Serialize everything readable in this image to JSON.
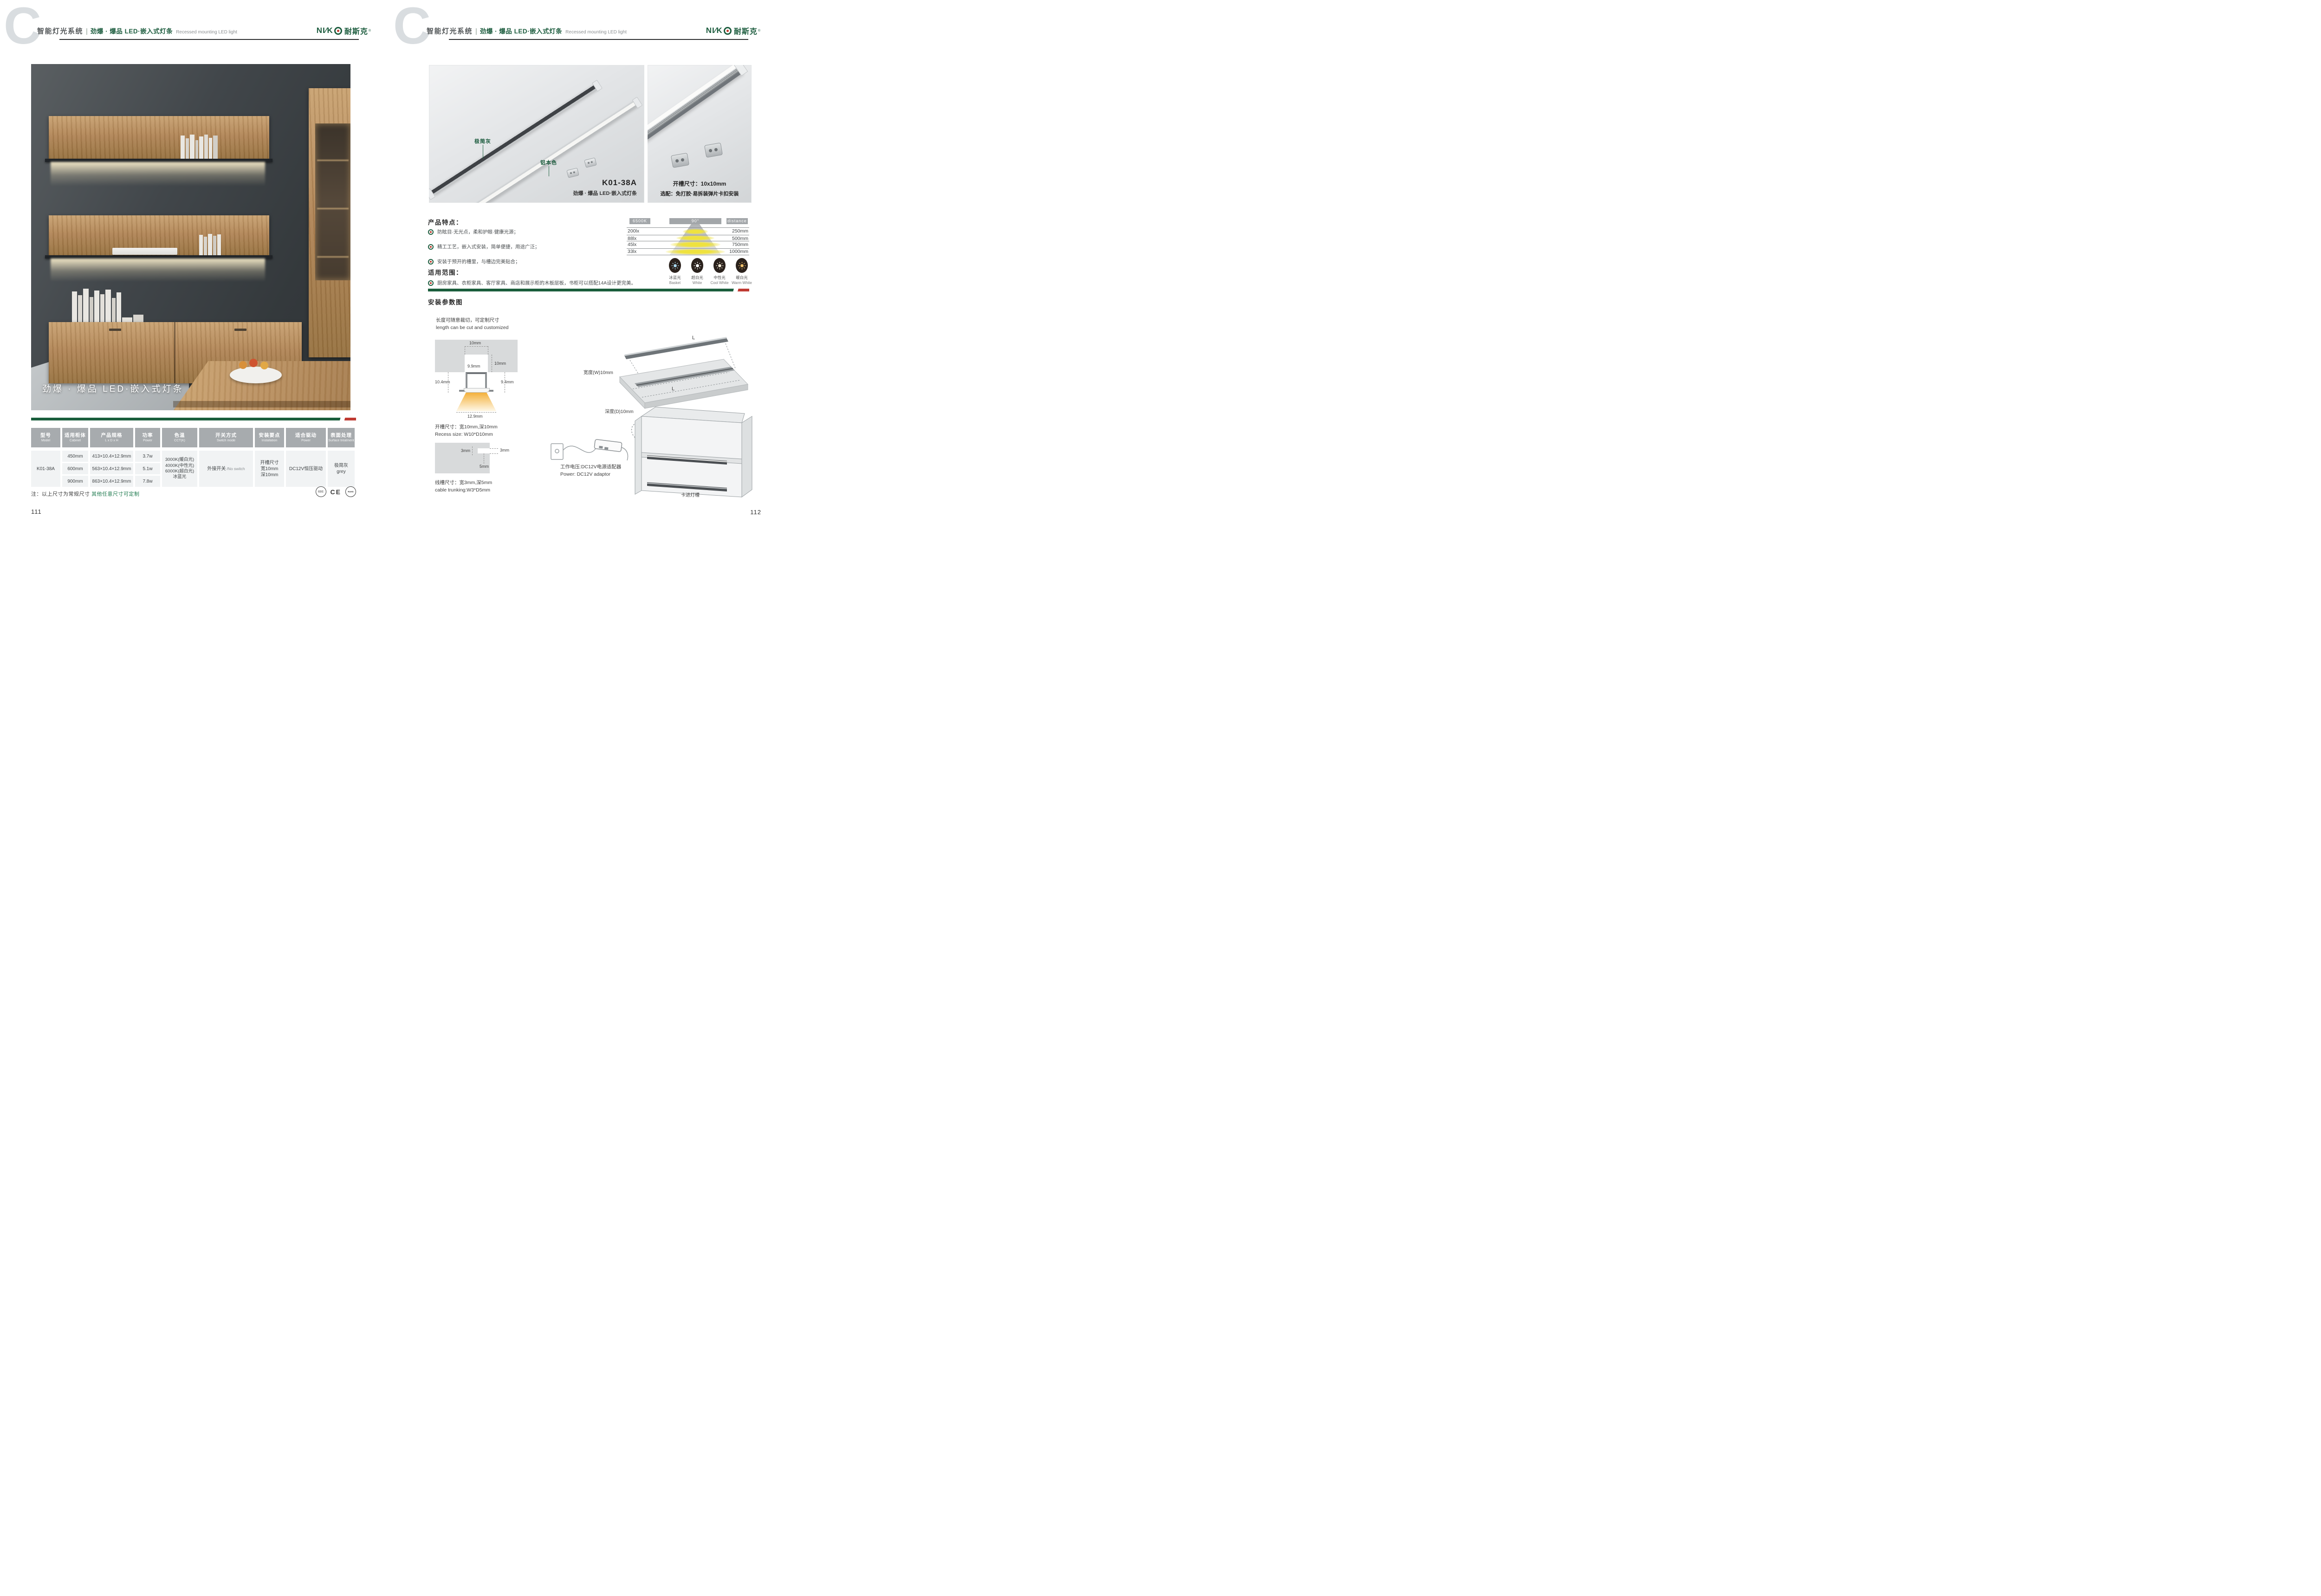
{
  "header": {
    "section_letter": "C",
    "system_title": "智能灯光系统",
    "divider": "|",
    "product_title_cn": "劲爆 · 爆品  LED·嵌入式灯条",
    "product_title_en": "Recessed mounting LED light",
    "logo": {
      "latin": "NI∕K",
      "cn": "耐斯克",
      "reg": "®"
    }
  },
  "left_page": {
    "photo_overlay_title": "劲爆 · 爆品  LED·嵌入式灯条",
    "table": {
      "headers": [
        {
          "cn": "型号",
          "en": "Model"
        },
        {
          "cn": "适用柜体",
          "en": "Cabinet"
        },
        {
          "cn": "产品规格",
          "en": "L x D x H"
        },
        {
          "cn": "功率",
          "en": "Power"
        },
        {
          "cn": "色温",
          "en": "CCT(K)"
        },
        {
          "cn": "开关方式",
          "en": "Switch mode"
        },
        {
          "cn": "安装要点",
          "en": "Installation"
        },
        {
          "cn": "适合驱动",
          "en": "Power"
        },
        {
          "cn": "表面处理",
          "en": "Surface treatment"
        }
      ],
      "model": "K01-38A",
      "rows": [
        {
          "cabinet": "450mm",
          "spec": "413×10.4×12.9mm",
          "power": "3.7w"
        },
        {
          "cabinet": "600mm",
          "spec": "563×10.4×12.9mm",
          "power": "5.1w"
        },
        {
          "cabinet": "900mm",
          "spec": "863×10.4×12.9mm",
          "power": "7.8w"
        }
      ],
      "cct_lines": [
        "3000K(暖白光)",
        "4000K(中性光)",
        "6000K(超白光)",
        "冰蓝光"
      ],
      "switch_cn": "外接开关",
      "switch_en": "/No switch",
      "install_lines": [
        "开槽尺寸",
        "宽10mm",
        "深10mm"
      ],
      "driver": "DC12V恒压驱动",
      "surface_cn": "极简灰",
      "surface_en": "grey"
    },
    "note_prefix": "注：以上尺寸为常规尺寸 ",
    "note_highlight": "其他任意尺寸可定制",
    "certs": [
      "CCC",
      "CE",
      "RoHS"
    ],
    "page_number": "111"
  },
  "right_page": {
    "photo_main": {
      "label_grey": "极简灰",
      "label_aluminum": "铝本色",
      "model": "K01-38A",
      "caption": "劲爆 · 爆品  LED·嵌入式灯条"
    },
    "photo_detail": {
      "caption_line1": "开槽尺寸：10x10mm",
      "caption_line2": "选配：免打胶·易拆装弹片卡扣安装"
    },
    "features": {
      "heading": "产品特点：",
      "items": [
        "防眩目·无光点，柔和护眼·健康光源；",
        "精工工艺，嵌入式安装，简单便捷，用途广泛；",
        "安装于预开的槽里，与槽边完美贴合；"
      ]
    },
    "scope": {
      "heading": "适用范围：",
      "item": "厨房家具、衣柜家具、客厅家具、商店和展示柜的木板层板，书柜可以搭配14A设计更完美。"
    },
    "swatches": [
      {
        "cn": "冰蓝光",
        "en": "Basket",
        "color": "#a9d9f2"
      },
      {
        "cn": "超白光",
        "en": "White",
        "color": "#ffffff"
      },
      {
        "cn": "中性光",
        "en": "Cool White",
        "color": "#f7eed9"
      },
      {
        "cn": "暖白光",
        "en": "Warm White",
        "color": "#f0c06a"
      }
    ],
    "install": {
      "heading": "安装参数图",
      "cut_note_cn": "长度可随意裁切，可定制尺寸",
      "cut_note_en": "length can be cut and customized",
      "cross_section": {
        "top_width": "10mm",
        "depth": "10mm",
        "inner_width": "9.9mm",
        "left_height": "10.4mm",
        "right_height": "9.4mm",
        "bottom_width": "12.9mm"
      },
      "recess_cn": "开槽尺寸：宽10mm,深10mm",
      "recess_en": "Recess size: W10*D10mm",
      "trunk": {
        "top": "3mm",
        "left": "3mm",
        "bottom": "5mm"
      },
      "trunk_cn": "线槽尺寸：宽3mm,深5mm",
      "trunk_en": "cable trunking:W3*D5mm",
      "board": {
        "length_top": "L",
        "length_bottom": "L",
        "width_label": "宽度(W)10mm",
        "depth_label": "深度(D)10mm",
        "caption": "建议开槽尺寸"
      },
      "power_cn": "工作电压:DC12V电源适配器",
      "power_en": "Power: DC12V adaptor",
      "cabinet_label": "卡进灯槽"
    },
    "page_number": "112"
  },
  "chart_data": {
    "type": "table",
    "title": "Illuminance vs distance at 6500K, 90° beam angle",
    "headers": [
      "6500K",
      "90°",
      "distance"
    ],
    "rows": [
      {
        "illuminance": "200lx",
        "distance": "250mm"
      },
      {
        "illuminance": "88lx",
        "distance": "500mm"
      },
      {
        "illuminance": "45lx",
        "distance": "750mm"
      },
      {
        "illuminance": "33lx",
        "distance": "1000mm"
      }
    ],
    "legend_position": "none",
    "grid": true
  }
}
